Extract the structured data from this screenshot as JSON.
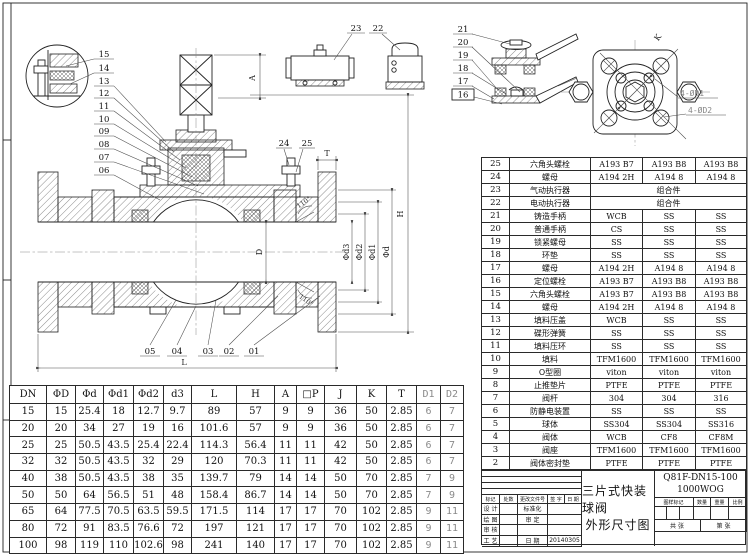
{
  "drawing": {
    "callouts": {
      "c01": "01",
      "c02": "02",
      "c03": "03",
      "c04": "04",
      "c05": "05",
      "c06": "06",
      "c07": "07",
      "c08": "08",
      "c09": "09",
      "c10": "10",
      "c11": "11",
      "c12": "12",
      "c13": "13",
      "c14": "14",
      "c15": "15",
      "c16": "16",
      "c17": "17",
      "c18": "18",
      "c19": "19",
      "c20": "20",
      "c21": "21",
      "c22": "22",
      "c23": "23",
      "c24": "24",
      "c25": "25"
    },
    "dims": {
      "a": "A",
      "h": "H",
      "t": "T",
      "d": "D",
      "l": "L",
      "phi_d3": "Φd3",
      "phi_d2": "Φd2",
      "phi_d1": "Φd1",
      "phi_d": "Φd",
      "angle": "110°",
      "holes_d1": "4-ØD1",
      "holes_d2": "4-ØD2",
      "k": "K"
    }
  },
  "parts_table": {
    "footer": {
      "no": "序 号",
      "name": "名      称",
      "material": "材      质"
    },
    "rows": [
      [
        "25",
        "六角头螺栓",
        "A193 B7",
        "A193 B8",
        "A193 B8"
      ],
      [
        "24",
        "螺母",
        "A194 2H",
        "A194 8",
        "A194 8"
      ],
      [
        "23",
        "气动执行器",
        {
          "text": "组合件",
          "colspan": 3
        }
      ],
      [
        "22",
        "电动执行器",
        {
          "text": "组合件",
          "colspan": 3
        }
      ],
      [
        "21",
        "铸造手柄",
        "WCB",
        "SS",
        "SS"
      ],
      [
        "20",
        "普通手柄",
        "CS",
        "SS",
        "SS"
      ],
      [
        "19",
        "锁紧螺母",
        "SS",
        "SS",
        "SS"
      ],
      [
        "18",
        "环垫",
        "SS",
        "SS",
        "SS"
      ],
      [
        "17",
        "螺母",
        "A194 2H",
        "A194 8",
        "A194 8"
      ],
      [
        "16",
        "定位螺栓",
        "A193 B7",
        "A193 B8",
        "A193 B8"
      ],
      [
        "15",
        "六角头螺栓",
        "A193 B7",
        "A193 B8",
        "A193 B8"
      ],
      [
        "14",
        "螺母",
        "A194 2H",
        "A194 8",
        "A194 8"
      ],
      [
        "13",
        "填料压盖",
        "WCB",
        "SS",
        "SS"
      ],
      [
        "12",
        "碟形弹簧",
        "SS",
        "SS",
        "SS"
      ],
      [
        "11",
        "填料压环",
        "SS",
        "SS",
        "SS"
      ],
      [
        "10",
        "填料",
        "TFM1600",
        "TFM1600",
        "TFM1600"
      ],
      [
        "9",
        "O型圈",
        "viton",
        "viton",
        "viton"
      ],
      [
        "8",
        "止推垫片",
        "PTFE",
        "PTFE",
        "PTFE"
      ],
      [
        "7",
        "阀杆",
        "304",
        "304",
        "316"
      ],
      [
        "6",
        "防静电装置",
        "SS",
        "SS",
        "SS"
      ],
      [
        "5",
        "球体",
        "SS304",
        "SS304",
        "SS316"
      ],
      [
        "4",
        "阀体",
        "WCB",
        "CF8",
        "CF8M"
      ],
      [
        "3",
        "阀座",
        "TFM1600",
        "TFM1600",
        "TFM1600"
      ],
      [
        "2",
        "阀体密封垫",
        "PTFE",
        "PTFE",
        "PTFE"
      ],
      [
        "1",
        "阀盖",
        "WCB",
        "CF8",
        "CF8M"
      ]
    ]
  },
  "dim_table": {
    "headers": [
      "DN",
      "ΦD",
      "Φd",
      "Φd1",
      "Φd2",
      "d3",
      "L",
      "H",
      "A",
      "□P",
      "J",
      "K",
      "T",
      "D1",
      "D2"
    ],
    "rows": [
      [
        "15",
        "15",
        "25.4",
        "18",
        "12.7",
        "9.7",
        "89",
        "57",
        "9",
        "9",
        "36",
        "50",
        "2.85",
        "6",
        "7"
      ],
      [
        "20",
        "20",
        "34",
        "27",
        "19",
        "16",
        "101.6",
        "57",
        "9",
        "9",
        "36",
        "50",
        "2.85",
        "6",
        "7"
      ],
      [
        "25",
        "25",
        "50.5",
        "43.5",
        "25.4",
        "22.4",
        "114.3",
        "56.4",
        "11",
        "11",
        "42",
        "50",
        "2.85",
        "6",
        "7"
      ],
      [
        "32",
        "32",
        "50.5",
        "43.5",
        "32",
        "29",
        "120",
        "70.3",
        "11",
        "11",
        "42",
        "50",
        "2.85",
        "6",
        "7"
      ],
      [
        "40",
        "38",
        "50.5",
        "43.5",
        "38",
        "35",
        "139.7",
        "79",
        "14",
        "14",
        "50",
        "70",
        "2.85",
        "7",
        "9"
      ],
      [
        "50",
        "50",
        "64",
        "56.5",
        "51",
        "48",
        "158.4",
        "86.7",
        "14",
        "14",
        "50",
        "70",
        "2.85",
        "7",
        "9"
      ],
      [
        "65",
        "64",
        "77.5",
        "70.5",
        "63.5",
        "59.5",
        "171.5",
        "114",
        "17",
        "17",
        "70",
        "102",
        "2.85",
        "9",
        "11"
      ],
      [
        "80",
        "72",
        "91",
        "83.5",
        "76.6",
        "72",
        "197",
        "121",
        "17",
        "17",
        "70",
        "102",
        "2.85",
        "9",
        "11"
      ],
      [
        "100",
        "98",
        "119",
        "110",
        "102.6",
        "98",
        "241",
        "140",
        "17",
        "17",
        "70",
        "102",
        "2.85",
        "9",
        "11"
      ]
    ]
  },
  "title_block": {
    "product_model": "Q81F-DN15-100",
    "pressure": "1000WOG",
    "title_line1": "三片式快装球阀",
    "title_line2": "外形尺寸图",
    "fields": {
      "mark": "标记",
      "count": "处数",
      "change_doc": "更改文件号",
      "sign": "签 字",
      "date": "日 期",
      "design": "设 计",
      "standardize": "标准化",
      "draw": "绘 图",
      "approve": "审 定",
      "check": "审 核",
      "craft": "工 艺",
      "date2": "日 期",
      "date_value": "20140305",
      "sample_mark": "图样标记",
      "quantity": "数量",
      "weight": "重量",
      "scale": "比例",
      "total_sheet": "共    张",
      "page_sheet": "第    张"
    }
  }
}
